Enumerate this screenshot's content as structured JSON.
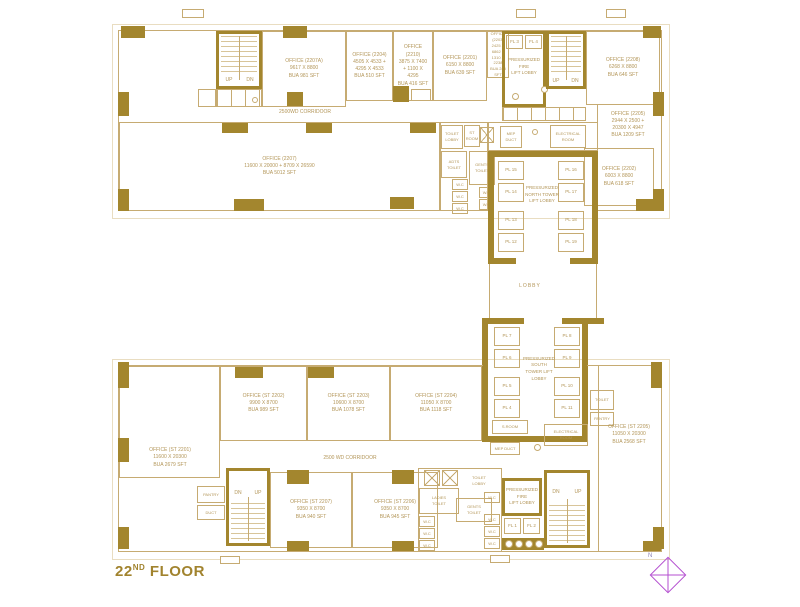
{
  "floor_title": {
    "number": "22",
    "suffix": "ND",
    "word": " FLOOR"
  },
  "compass": {
    "label": "N"
  },
  "colors": {
    "gold": "#a3862e",
    "line": "#c6ab72",
    "text": "#b39659",
    "compass": "#b44fd0",
    "title": "#a1832e"
  },
  "north_wing": {
    "office_2207a": "OFFICE (2207A)\n9617 X 8800\nBUA 981 SFT",
    "office_2204": "OFFICE (2204)\n4505 X 4533 +\n4295 X 4533\nBUA 510 SFT",
    "office_2210": "OFFICE\n(2210)\n3875 X 7400\n+ 1100 X\n4295\nBUA 416 SFT",
    "office_2201": "OFFICE (2201)\n6150 X 8800\nBUA 639 SFT",
    "office_2203": "OFFICE\n(2203)\n2425 X\n6862 +\n1310 X\n2238\nBUA 245\nSFT",
    "office_2208": "OFFICE (2208)\n6268 X 8800\nBUA 646 SFT",
    "office_2205": "OFFICE (2205)\n2944 X 2500 +\n20300 X 4947\nBUA 1209 SFT",
    "office_2202": "OFFICE (2202)\n6003 X 8800\nBUA 618 SFT",
    "office_2207": "OFFICE (2207)\n11600 X 20000 + 8709 X 26590\nBUA 5012 SFT",
    "corridor": "2500WD CORRIDOOR",
    "pressurized_fire_lift_lobby": "PRESSURIZED\nFIRE\nLIFT LOBBY",
    "fire_lift_3": "FL 3",
    "fire_lift_4": "FL 4",
    "stair_up": "UP",
    "stair_dn": "DN",
    "toilet_lobby": "TOILET\nLOBBY",
    "st_room": "ST\nROOM",
    "mep_duct": "MEP\nDUCT",
    "electrical_room": "ELECTRICAL\nROOM",
    "adts_toilet": "ADTS\nTOILET",
    "gents_toilet": "GENTS\nTOILET",
    "wc": "W.C"
  },
  "core": {
    "north_lift_lobby": "PRESSURIZED\nNORTH TOWER\nLIFT LOBBY",
    "lobby": "LOBBY",
    "south_lift_lobby": "PRESSURIZED\nSOUTH\nTOWER LIFT\nLOBBY",
    "lifts_north_left": [
      "PL 15",
      "PL 14",
      "PL 13",
      "PL 12"
    ],
    "lifts_north_right": [
      "PL 16",
      "PL 17",
      "PL 18",
      "PL 19"
    ],
    "lifts_south_left": [
      "PL 7",
      "PL 6",
      "PL 5",
      "PL 4"
    ],
    "lifts_south_right": [
      "PL 8",
      "PL 9",
      "PL 10",
      "PL 11"
    ]
  },
  "south_wing": {
    "office_st2201": "OFFICE (ST 2201)\n11600 X 20300\nBUA 2679 SFT",
    "office_st2202": "OFFICE (ST 2202)\n9900 X 8700\nBUA 989 SFT",
    "office_st2203": "OFFICE (ST 2203)\n10600 X 8700\nBUA 1078 SFT",
    "office_st2204": "OFFICE (ST 2204)\n11050 X 8700\nBUA 1118 SFT",
    "office_st2205": "OFFICE (ST 2205)\n11050 X 20300\nBUA 2568 SFT",
    "office_st2206": "OFFICE (ST 2206)\n9350 X 8700\nBUA 945 SFT",
    "office_st2207": "OFFICE (ST 2207)\n9350 X 8700\nBUA 940 SFT",
    "corridor": "2500 WD CORRIDOOR",
    "s_room": "S.ROOM",
    "mep_duct": "MEP DUCT",
    "electrical_room": "ELECTRICAL\nROOM",
    "toilet": "TOILET",
    "pantry_right": "PANTRY",
    "toilet_lobby": "TOILET\nLOBBY",
    "ladies_toilet": "LADIES\nTOILET",
    "gents_toilet": "GENTS\nTOILET",
    "wc": "W.C",
    "pressurized_fire_lift_lobby": "PRESSURIZED\nFIRE\nLIFT LOBBY",
    "fire_lift_1": "FL 1",
    "fire_lift_2": "FL 2",
    "stair_dn": "DN",
    "stair_up": "UP",
    "pantry": "PANTRY",
    "duct": "DUCT"
  }
}
